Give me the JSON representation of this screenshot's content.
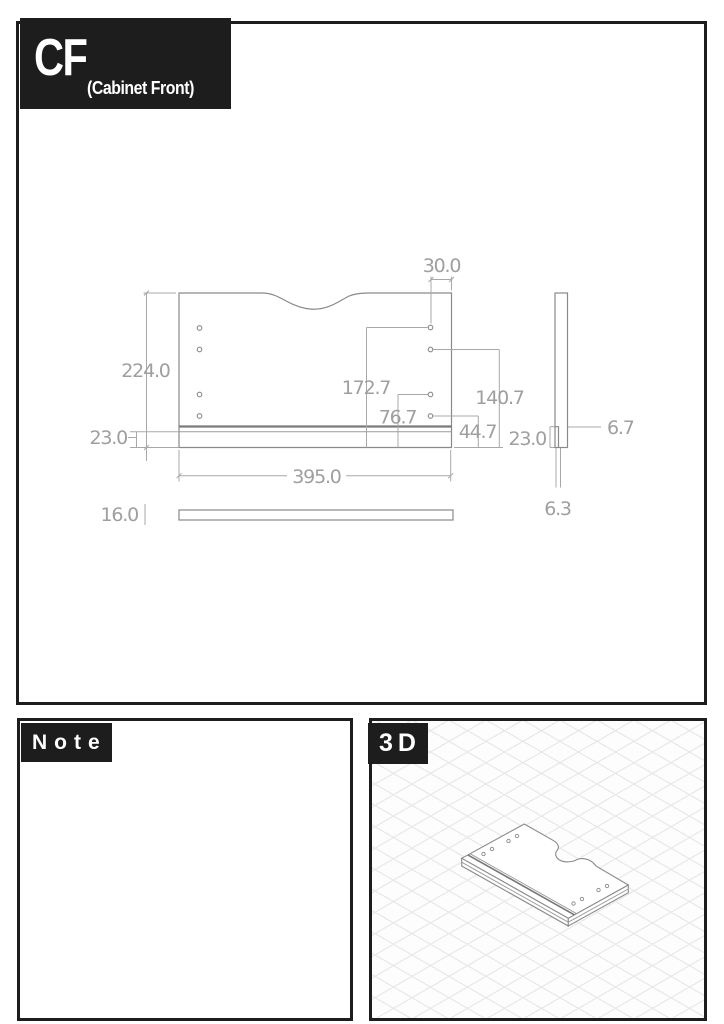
{
  "header": {
    "code": "CF",
    "name": "(Cabinet Front)"
  },
  "front_view": {
    "dim_hole_offset_top": "30.0",
    "dim_height": "224.0",
    "dim_rail_height": "23.0",
    "dim_hole1_from_bottom": "172.7",
    "dim_hole2_from_bottom": "140.7",
    "dim_hole3_from_bottom": "76.7",
    "dim_hole4_from_bottom": "44.7",
    "dim_width": "395.0"
  },
  "side_view": {
    "dim_rail_height": "23.0",
    "dim_step": "6.7",
    "dim_thin": "6.3"
  },
  "bottom_view": {
    "dim_thickness": "16.0"
  },
  "note": {
    "title": "Note",
    "line1": "1개 통원목 사용하기"
  },
  "viewer_3d": {
    "title": "3D"
  },
  "colors": {
    "frame": "#1d1d1d",
    "line": "#8a8a8a",
    "dim_line": "#a8a8a8",
    "dim_text": "#9f9f9f",
    "grid": "#e8e8e8"
  }
}
